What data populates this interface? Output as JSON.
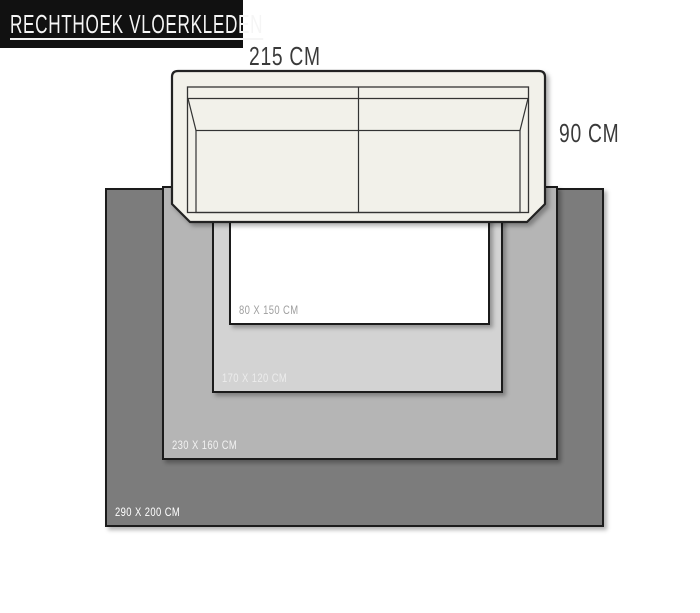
{
  "title": "RECHTHOEK VLOERKLEDEN",
  "sofa": {
    "width_label": "215 CM",
    "depth_label": "90 CM",
    "body_color": "#f2f1ea",
    "outline_color": "#222222"
  },
  "rugs": [
    {
      "name": "rug-290x200",
      "label": "290 X 200 CM",
      "bg": "#7c7c7c",
      "fg": "#ffffff"
    },
    {
      "name": "rug-230x160",
      "label": "230 X 160 CM",
      "bg": "#b5b5b5",
      "fg": "#f2f2f2"
    },
    {
      "name": "rug-170x120",
      "label": "170 X 120 CM",
      "bg": "#d3d3d3",
      "fg": "#ececec"
    },
    {
      "name": "rug-80x150",
      "label": "80 X 150 CM",
      "bg": "#ffffff",
      "fg": "#9e9e9e"
    }
  ]
}
